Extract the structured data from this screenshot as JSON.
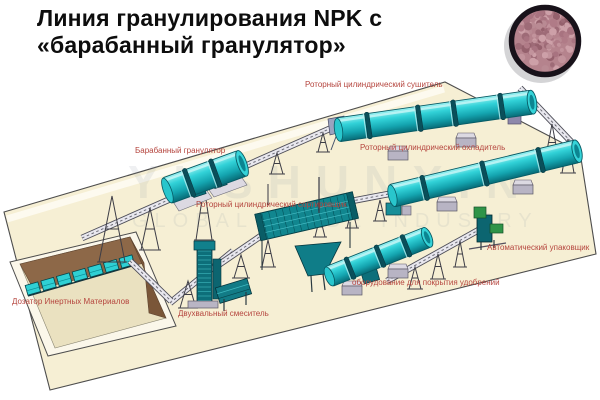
{
  "title": {
    "line1": "Линия гранулирования NPK с",
    "line2": "«барабанный гранулятор»"
  },
  "labels": {
    "dryer": "Роторный цилиндрический сушитель",
    "cooler": "Роторный цилиндрический охладитель",
    "granulator": "Барабанный гранулятор",
    "screener": "Роторный цилиндрический сортировщик",
    "packer": "Автоматический упаковщик",
    "coating": "оборудование для покрытия удобрений",
    "doser": "Дозатор Инертных Материалов",
    "mixer": "Двухвальный смеситель"
  },
  "watermark": {
    "line1": "YUSHUNXIN",
    "line2": "GLOBAL TRADE INDUSTRY"
  },
  "colors": {
    "title": "#0d0d0d",
    "label": "#b5453e",
    "platform": "#f6efd4",
    "platform_outline": "#4d4d4d",
    "machine_teal": "#2ecdd3",
    "machine_teal_dark": "#0b6e79",
    "pit_wall": "#8d6848",
    "pit_wall_dark": "#7a5638",
    "support_gray": "#b8b4c4",
    "packer_green": "#2f9448",
    "granules_base": "#b5838d",
    "inset_ring": "#18121a",
    "watermark": "#8c95a0"
  }
}
